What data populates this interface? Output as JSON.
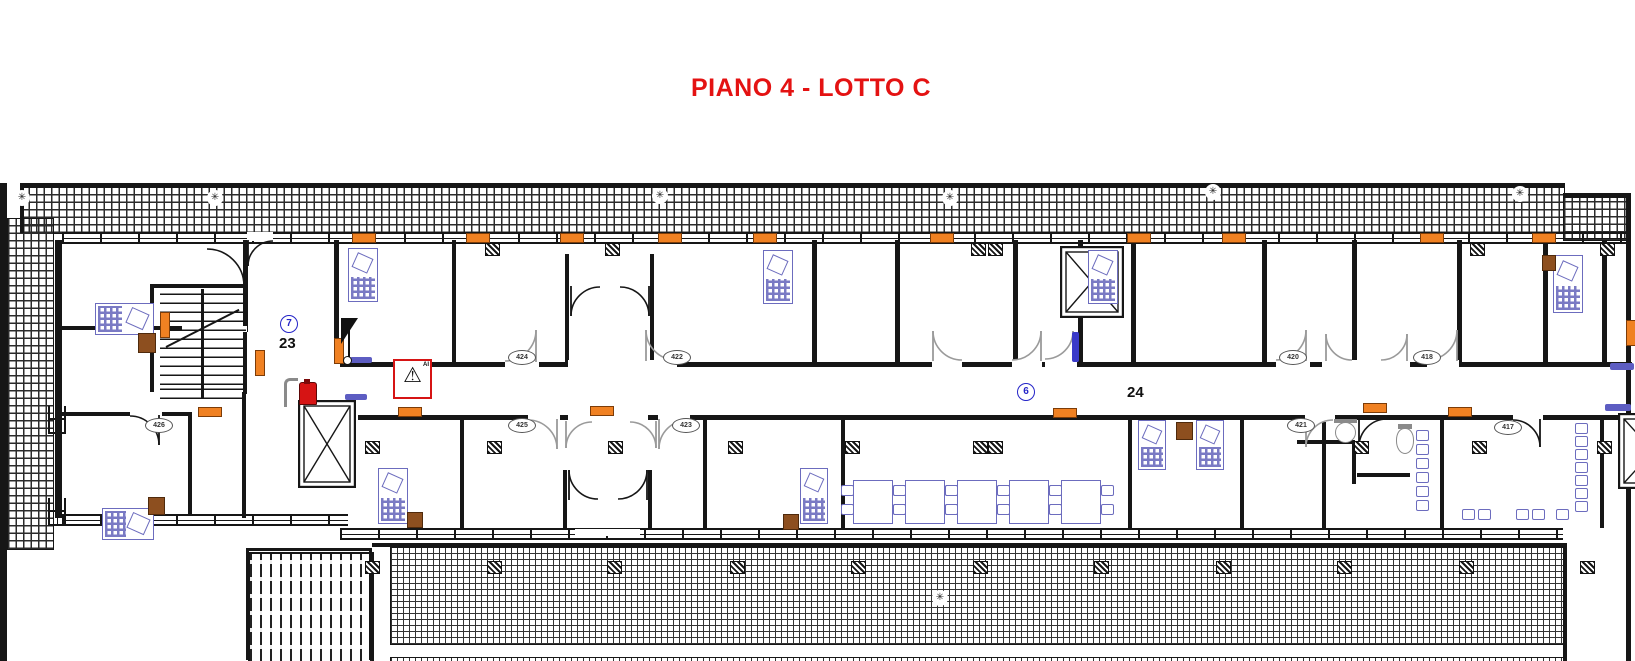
{
  "title": {
    "text": "PIANO 4 - LOTTO C"
  },
  "colors": {
    "wall": "#161616",
    "furniture": "#6c6cbe",
    "radiator": "#f08122",
    "cabinet": "#8d4f1f",
    "door_gray": "#9a9a9a",
    "door_black": "#161616",
    "accent_red": "#d61414",
    "label_blue": "#2424c8",
    "title_red": "#e41212"
  },
  "plan": {
    "hatches_coarse": [
      [
        20,
        187,
        1543,
        45
      ],
      [
        1563,
        197,
        64,
        42
      ],
      [
        7,
        218,
        45,
        330
      ]
    ],
    "hatches_fine": [
      [
        390,
        547,
        1173,
        96
      ],
      [
        390,
        657,
        1173,
        4
      ]
    ],
    "stripes": [
      [
        248,
        552,
        122,
        108
      ]
    ],
    "windows_h": [
      [
        62,
        232,
        1568,
        8
      ],
      [
        340,
        528,
        1223,
        8
      ],
      [
        62,
        514,
        286,
        8
      ]
    ],
    "windows_v": [
      [
        48,
        406,
        14,
        28
      ],
      [
        48,
        498,
        14,
        28
      ]
    ],
    "walls": [
      [
        0,
        183,
        7,
        478
      ],
      [
        20,
        183,
        1545,
        4
      ],
      [
        20,
        183,
        4,
        50
      ],
      [
        1563,
        193,
        67,
        4
      ],
      [
        1626,
        193,
        5,
        468
      ],
      [
        55,
        240,
        7,
        278
      ],
      [
        243,
        240,
        5,
        92
      ],
      [
        150,
        284,
        98,
        4
      ],
      [
        150,
        284,
        4,
        108
      ],
      [
        243,
        330,
        4,
        64
      ],
      [
        62,
        326,
        120,
        4
      ],
      [
        214,
        326,
        33,
        4
      ],
      [
        62,
        412,
        70,
        4
      ],
      [
        158,
        412,
        32,
        4
      ],
      [
        188,
        412,
        4,
        104
      ],
      [
        242,
        392,
        4,
        126
      ],
      [
        334,
        240,
        5,
        124
      ],
      [
        340,
        362,
        1292,
        5
      ],
      [
        358,
        415,
        1274,
        5
      ],
      [
        452,
        240,
        4,
        122
      ],
      [
        565,
        254,
        4,
        110
      ],
      [
        650,
        254,
        4,
        110
      ],
      [
        812,
        240,
        5,
        122
      ],
      [
        895,
        240,
        5,
        122
      ],
      [
        1013,
        240,
        5,
        122
      ],
      [
        1078,
        240,
        5,
        122
      ],
      [
        1131,
        240,
        5,
        122
      ],
      [
        1262,
        240,
        5,
        122
      ],
      [
        1352,
        240,
        5,
        122
      ],
      [
        1457,
        240,
        5,
        122
      ],
      [
        1543,
        240,
        5,
        122
      ],
      [
        1602,
        240,
        5,
        122
      ],
      [
        460,
        420,
        4,
        108
      ],
      [
        563,
        470,
        4,
        60
      ],
      [
        648,
        470,
        4,
        60
      ],
      [
        703,
        420,
        4,
        108
      ],
      [
        841,
        420,
        4,
        108
      ],
      [
        1128,
        420,
        4,
        108
      ],
      [
        1240,
        420,
        4,
        108
      ],
      [
        1322,
        420,
        4,
        108
      ],
      [
        1440,
        420,
        4,
        108
      ],
      [
        1600,
        420,
        4,
        108
      ],
      [
        1297,
        440,
        58,
        4
      ],
      [
        1352,
        442,
        4,
        42
      ],
      [
        1357,
        473,
        53,
        4
      ],
      [
        372,
        543,
        1191,
        4
      ],
      [
        1563,
        543,
        4,
        118
      ],
      [
        246,
        548,
        126,
        3
      ],
      [
        246,
        548,
        3,
        112
      ],
      [
        369,
        548,
        3,
        112
      ]
    ],
    "gaps": [
      [
        505,
        360,
        34,
        9
      ],
      [
        645,
        360,
        32,
        9
      ],
      [
        1276,
        360,
        34,
        9
      ],
      [
        1427,
        360,
        32,
        9
      ],
      [
        1322,
        360,
        88,
        9
      ],
      [
        528,
        413,
        32,
        9
      ],
      [
        658,
        413,
        32,
        9
      ],
      [
        1305,
        413,
        30,
        9
      ],
      [
        1513,
        413,
        30,
        9
      ],
      [
        130,
        410,
        32,
        7
      ],
      [
        1045,
        360,
        32,
        9
      ],
      [
        568,
        360,
        84,
        9
      ],
      [
        568,
        413,
        80,
        9
      ],
      [
        205,
        326,
        42,
        6
      ],
      [
        247,
        232,
        26,
        9
      ],
      [
        575,
        529,
        65,
        7
      ],
      [
        932,
        360,
        30,
        9
      ],
      [
        1012,
        360,
        30,
        9
      ]
    ],
    "doors": [
      {
        "x": 505,
        "y": 330,
        "r": 32,
        "sx": -1,
        "sy": -1,
        "c": "#9a9a9a"
      },
      {
        "x": 645,
        "y": 330,
        "r": 31,
        "sx": 1,
        "sy": -1,
        "c": "#9a9a9a"
      },
      {
        "x": 1276,
        "y": 330,
        "r": 31,
        "sx": -1,
        "sy": -1,
        "c": "#9a9a9a"
      },
      {
        "x": 1427,
        "y": 330,
        "r": 31,
        "sx": -1,
        "sy": -1,
        "c": "#9a9a9a"
      },
      {
        "x": 1325,
        "y": 334,
        "r": 27,
        "sx": 1,
        "sy": -1,
        "c": "#9a9a9a"
      },
      {
        "x": 1381,
        "y": 334,
        "r": 27,
        "sx": -1,
        "sy": -1,
        "c": "#9a9a9a"
      },
      {
        "x": 528,
        "y": 419,
        "r": 30,
        "sx": -1,
        "sy": 1,
        "c": "#9a9a9a"
      },
      {
        "x": 658,
        "y": 419,
        "r": 30,
        "sx": 1,
        "sy": 1,
        "c": "#9a9a9a"
      },
      {
        "x": 1305,
        "y": 419,
        "r": 28,
        "sx": 1,
        "sy": 1,
        "c": "#9a9a9a"
      },
      {
        "x": 1513,
        "y": 419,
        "r": 28,
        "sx": -1,
        "sy": 1,
        "c": "#161616"
      },
      {
        "x": 130,
        "y": 415,
        "r": 30,
        "sx": -1,
        "sy": 1,
        "c": "#161616"
      },
      {
        "x": 932,
        "y": 331,
        "r": 30,
        "sx": 1,
        "sy": -1,
        "c": "#9a9a9a"
      },
      {
        "x": 1012,
        "y": 331,
        "r": 30,
        "sx": -1,
        "sy": -1,
        "c": "#9a9a9a"
      },
      {
        "x": 1045,
        "y": 331,
        "r": 29,
        "sx": -1,
        "sy": -1,
        "c": "#9a9a9a"
      },
      {
        "x": 570,
        "y": 286,
        "r": 30,
        "sx": 1,
        "sy": 1,
        "c": "#161616"
      },
      {
        "x": 620,
        "y": 286,
        "r": 30,
        "sx": -1,
        "sy": 1,
        "c": "#161616"
      },
      {
        "x": 568,
        "y": 470,
        "r": 30,
        "sx": 1,
        "sy": -1,
        "c": "#161616"
      },
      {
        "x": 618,
        "y": 470,
        "r": 30,
        "sx": -1,
        "sy": -1,
        "c": "#161616"
      },
      {
        "x": 565,
        "y": 421,
        "r": 27,
        "sx": 1,
        "sy": 1,
        "c": "#9a9a9a"
      },
      {
        "x": 630,
        "y": 421,
        "r": 27,
        "sx": -1,
        "sy": 1,
        "c": "#9a9a9a"
      },
      {
        "x": 207,
        "y": 248,
        "r": 38,
        "sx": -1,
        "sy": 1,
        "c": "#161616"
      },
      {
        "x": 247,
        "y": 240,
        "r": 26,
        "sx": 1,
        "sy": 1,
        "c": "#161616"
      },
      {
        "x": 1358,
        "y": 418,
        "r": 29,
        "sx": 1,
        "sy": 1,
        "c": "#161616"
      }
    ],
    "elevators": [
      [
        298,
        400,
        58,
        88
      ],
      [
        1060,
        246,
        64,
        72
      ],
      [
        1618,
        413,
        70,
        76
      ]
    ],
    "stairs": {
      "main": [
        160,
        289,
        86,
        96
      ],
      "lower": [
        160,
        385,
        86,
        14
      ],
      "stringer": [
        201,
        289,
        3,
        110
      ],
      "arrow": {
        "x": 166,
        "y": 346,
        "len": 82,
        "angle": -27
      }
    },
    "desks": [
      [
        95,
        303,
        57,
        30
      ],
      [
        102,
        508,
        50,
        30
      ],
      [
        348,
        248,
        28,
        52
      ],
      [
        763,
        250,
        28,
        52
      ],
      [
        1088,
        250,
        28,
        52
      ],
      [
        1553,
        255,
        28,
        56
      ],
      [
        378,
        468,
        28,
        54
      ],
      [
        800,
        468,
        26,
        54
      ],
      [
        1138,
        420,
        26,
        48
      ],
      [
        1196,
        420,
        26,
        48
      ]
    ],
    "tables": {
      "xs": [
        853,
        905,
        957,
        1009,
        1061
      ],
      "y": 480,
      "w": 38,
      "h": 42
    },
    "chairs": [
      [
        1416,
        430
      ],
      [
        1416,
        444
      ],
      [
        1416,
        458
      ],
      [
        1416,
        472
      ],
      [
        1416,
        486
      ],
      [
        1416,
        500
      ],
      [
        1575,
        423
      ],
      [
        1575,
        436
      ],
      [
        1575,
        449
      ],
      [
        1575,
        462
      ],
      [
        1575,
        475
      ],
      [
        1575,
        488
      ],
      [
        1575,
        501
      ],
      [
        1462,
        509
      ],
      [
        1478,
        509
      ],
      [
        1516,
        509
      ],
      [
        1532,
        509
      ],
      [
        1556,
        509
      ]
    ],
    "columns": [
      {
        "y": 243,
        "xs": [
          485,
          605,
          971,
          988,
          1470,
          1600
        ]
      },
      {
        "y": 441,
        "xs": [
          365,
          487,
          608,
          728,
          845,
          973,
          988,
          1354,
          1472,
          1597
        ]
      },
      {
        "y": 561,
        "xs": [
          365,
          487,
          607,
          730,
          851,
          973,
          1094,
          1216,
          1337,
          1459,
          1580
        ]
      }
    ],
    "radiators_h": [
      [
        352,
        233
      ],
      [
        466,
        233
      ],
      [
        560,
        233
      ],
      [
        658,
        233
      ],
      [
        753,
        233
      ],
      [
        930,
        233
      ],
      [
        1127,
        233
      ],
      [
        1222,
        233
      ],
      [
        1420,
        233
      ],
      [
        1532,
        233
      ],
      [
        198,
        407
      ],
      [
        398,
        407
      ],
      [
        590,
        406
      ],
      [
        1053,
        408
      ],
      [
        1363,
        403
      ],
      [
        1448,
        407
      ]
    ],
    "radiators_v": [
      [
        160,
        312
      ],
      [
        255,
        350
      ],
      [
        334,
        338
      ],
      [
        1626,
        320
      ]
    ],
    "cabinets": [
      [
        138,
        333,
        16,
        18
      ],
      [
        148,
        497,
        15,
        16
      ],
      [
        407,
        512,
        14,
        14
      ],
      [
        783,
        514,
        14,
        14
      ],
      [
        1176,
        422,
        15,
        16
      ],
      [
        1542,
        255,
        12,
        14
      ]
    ],
    "thresholds": [
      [
        350,
        357,
        22,
        6
      ],
      [
        345,
        394,
        22,
        6
      ],
      [
        1610,
        363,
        24,
        7
      ],
      [
        1605,
        404,
        26,
        7
      ]
    ],
    "bluebars": [
      [
        1072,
        332,
        7,
        30
      ]
    ],
    "room_numbers": [
      {
        "n": "426",
        "x": 158,
        "y": 425
      },
      {
        "n": "424",
        "x": 521,
        "y": 357
      },
      {
        "n": "422",
        "x": 676,
        "y": 357
      },
      {
        "n": "420",
        "x": 1292,
        "y": 357
      },
      {
        "n": "418",
        "x": 1426,
        "y": 357
      },
      {
        "n": "425",
        "x": 521,
        "y": 425
      },
      {
        "n": "423",
        "x": 685,
        "y": 425
      },
      {
        "n": "421",
        "x": 1300,
        "y": 425
      },
      {
        "n": "417",
        "x": 1507,
        "y": 427
      }
    ],
    "zone_labels": [
      {
        "n": "7",
        "x": 289,
        "y": 324,
        "circ": true
      },
      {
        "n": "23",
        "x": 291,
        "y": 344,
        "circ": false
      },
      {
        "n": "6",
        "x": 1026,
        "y": 392,
        "circ": true
      },
      {
        "n": "24",
        "x": 1139,
        "y": 393,
        "circ": false
      }
    ],
    "posts": [
      [
        22,
        198
      ],
      [
        215,
        198
      ],
      [
        660,
        196
      ],
      [
        950,
        198
      ],
      [
        1213,
        192
      ],
      [
        1520,
        194
      ],
      [
        940,
        598
      ]
    ],
    "post_glyph": "✳",
    "warning_sign": {
      "x": 393,
      "y": 359,
      "w": 35,
      "h": 36,
      "glyph": "⚠",
      "tag": "AI"
    },
    "extinguisher": {
      "x": 299,
      "y": 382,
      "w": 16,
      "h": 21
    },
    "hose_hook": {
      "x": 284,
      "y": 378,
      "w": 11,
      "h": 26
    },
    "hose_reel": {
      "pole": [
        348,
        318,
        2,
        42
      ],
      "tri": [
        341,
        318,
        17,
        26
      ],
      "ring": [
        343,
        356,
        7,
        7
      ]
    },
    "sink": {
      "x": 1335,
      "y": 422,
      "w": 19,
      "h": 19
    },
    "toilet": {
      "x": 1396,
      "y": 428,
      "w": 16,
      "h": 24
    }
  }
}
